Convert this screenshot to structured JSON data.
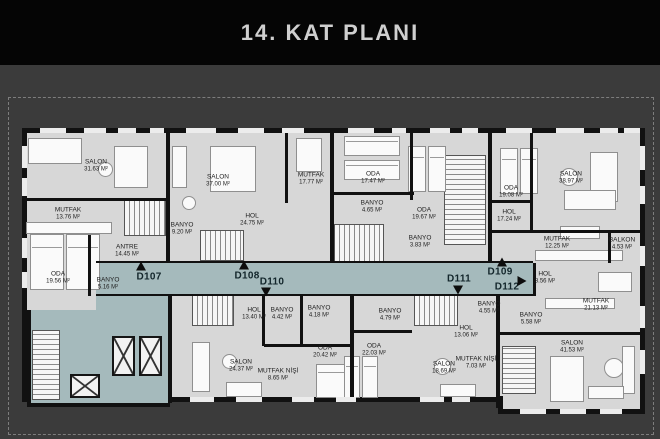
{
  "title": "14. KAT PLANI",
  "colors": {
    "header_bg": "#050505",
    "header_text": "#cfcfcf",
    "backdrop": "#3b3b3b",
    "plan_fill": "#d7d7d7",
    "wall": "#111111",
    "corridor": "#a5babc",
    "label_text": "#1d1d1d"
  },
  "plan": {
    "rooms": [
      {
        "name": "SALON",
        "area": "31.63 M²",
        "x": 96,
        "y": 166
      },
      {
        "name": "MUTFAK",
        "area": "13.76 M²",
        "x": 68,
        "y": 214
      },
      {
        "name": "ODA",
        "area": "19.56 M²",
        "x": 58,
        "y": 278
      },
      {
        "name": "ANTRE",
        "area": "14.45 M²",
        "x": 127,
        "y": 251
      },
      {
        "name": "BANYO",
        "area": "5.16 M²",
        "x": 108,
        "y": 284
      },
      {
        "name": "SALON",
        "area": "37.00 M²",
        "x": 218,
        "y": 181
      },
      {
        "name": "MUTFAK",
        "area": "17.77 M²",
        "x": 311,
        "y": 179
      },
      {
        "name": "BANYO",
        "area": "9.20 M²",
        "x": 182,
        "y": 229
      },
      {
        "name": "HOL",
        "area": "24.75 M²",
        "x": 252,
        "y": 220
      },
      {
        "name": "ODA",
        "area": "17.47 M²",
        "x": 373,
        "y": 178
      },
      {
        "name": "BANYO",
        "area": "4.65 M²",
        "x": 372,
        "y": 207
      },
      {
        "name": "ODA",
        "area": "19.67 M²",
        "x": 424,
        "y": 214
      },
      {
        "name": "BANYO",
        "area": "3.83 M²",
        "x": 420,
        "y": 242
      },
      {
        "name": "ODA",
        "area": "19.08 M²",
        "x": 511,
        "y": 192
      },
      {
        "name": "SALON",
        "area": "38.97 M²",
        "x": 571,
        "y": 178
      },
      {
        "name": "HOL",
        "area": "17.24 M²",
        "x": 509,
        "y": 216
      },
      {
        "name": "MUTFAK",
        "area": "12.25 M²",
        "x": 557,
        "y": 243
      },
      {
        "name": "BALKON",
        "area": "4.53 M²",
        "x": 622,
        "y": 244
      },
      {
        "name": "HOL",
        "area": "8.56 M²",
        "x": 545,
        "y": 278
      },
      {
        "name": "MUTFAK",
        "area": "21.13 M²",
        "x": 596,
        "y": 305
      },
      {
        "name": "BANYO",
        "area": "5.58 M²",
        "x": 531,
        "y": 319
      },
      {
        "name": "SALON",
        "area": "41.53 M²",
        "x": 572,
        "y": 347
      },
      {
        "name": "HOL",
        "area": "13.40 M²",
        "x": 254,
        "y": 314
      },
      {
        "name": "BANYO",
        "area": "4.42 M²",
        "x": 282,
        "y": 314
      },
      {
        "name": "BANYO",
        "area": "4.18 M²",
        "x": 319,
        "y": 312
      },
      {
        "name": "SALON",
        "area": "24.37 M²",
        "x": 241,
        "y": 366
      },
      {
        "name": "MUTFAK NİŞİ",
        "area": "8.65 M²",
        "x": 278,
        "y": 375
      },
      {
        "name": "ODA",
        "area": "20.42 M²",
        "x": 325,
        "y": 352
      },
      {
        "name": "BANYO",
        "area": "4.79 M²",
        "x": 390,
        "y": 315
      },
      {
        "name": "ODA",
        "area": "22.03 M²",
        "x": 374,
        "y": 350
      },
      {
        "name": "HOL",
        "area": "13.06 M²",
        "x": 466,
        "y": 332
      },
      {
        "name": "SALON",
        "area": "18.69 M²",
        "x": 444,
        "y": 368
      },
      {
        "name": "MUTFAK NİŞİ",
        "area": "7.03 M²",
        "x": 476,
        "y": 363
      },
      {
        "name": "BANYO",
        "area": "4.55 M²",
        "x": 489,
        "y": 308
      }
    ],
    "units": [
      {
        "id": "D107",
        "arrow": "up",
        "x": 149,
        "y": 277,
        "ax": 141,
        "ay": 266
      },
      {
        "id": "D108",
        "arrow": "up",
        "x": 247,
        "y": 276,
        "ax": 244,
        "ay": 265
      },
      {
        "id": "D110",
        "arrow": "down",
        "x": 272,
        "y": 282,
        "ax": 266,
        "ay": 292
      },
      {
        "id": "D111",
        "arrow": "down",
        "x": 459,
        "y": 279,
        "ax": 458,
        "ay": 290
      },
      {
        "id": "D109",
        "arrow": "up",
        "x": 500,
        "y": 272,
        "ax": 502,
        "ay": 262
      },
      {
        "id": "D112",
        "arrow": "right",
        "x": 507,
        "y": 287,
        "ax": 522,
        "ay": 281
      }
    ]
  }
}
